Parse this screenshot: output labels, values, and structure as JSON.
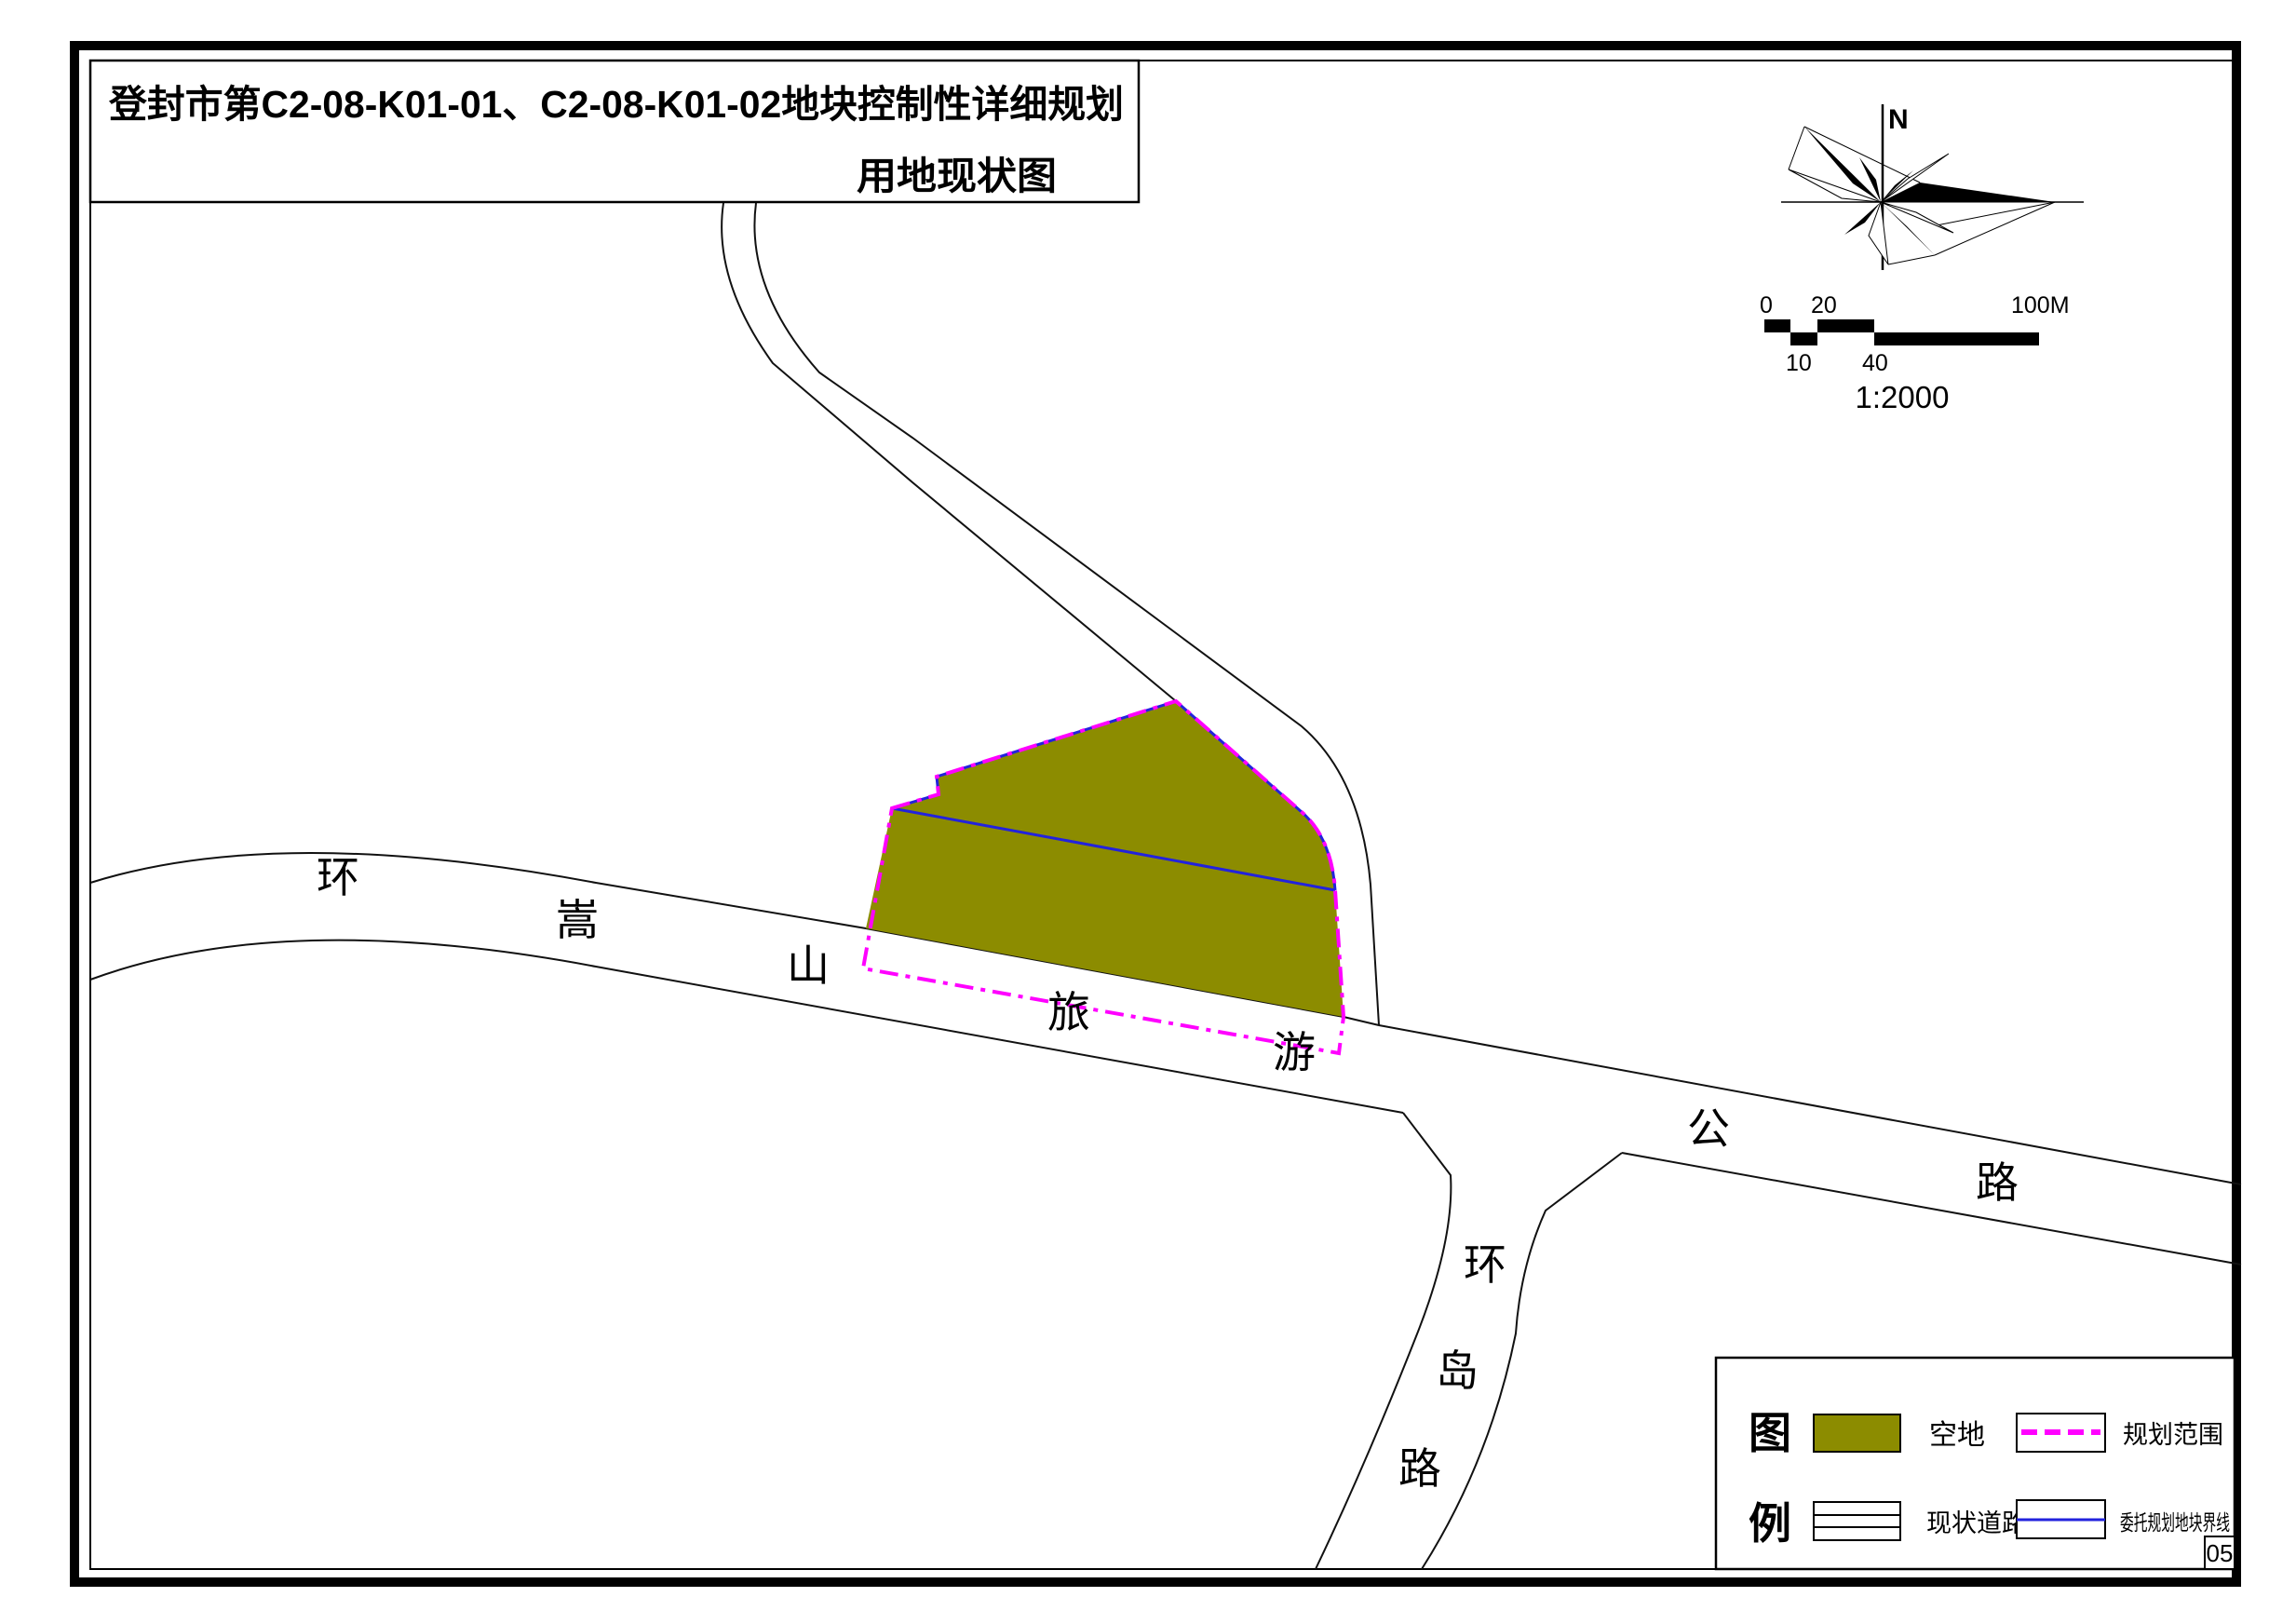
{
  "page": {
    "page_number": "05",
    "background": "#ffffff",
    "border_color": "#000000"
  },
  "title": {
    "line1": "登封市第C2-08-K01-01、C2-08-K01-02地块控制性详细规划",
    "line2": "用地现状图"
  },
  "compass": {
    "north_label": "N"
  },
  "scale_bar": {
    "tick_0": "0",
    "tick_20": "20",
    "tick_100": "100M",
    "tick_10": "10",
    "tick_40": "40",
    "ratio": "1:2000"
  },
  "roads": {
    "ring_songshan_tourism_highway": {
      "name": "环嵩山旅游公路",
      "chars": [
        "环",
        "嵩",
        "山",
        "旅",
        "游",
        "公",
        "路"
      ]
    },
    "ring_island_road": {
      "name": "环岛路",
      "chars": [
        "环",
        "岛",
        "路"
      ]
    }
  },
  "legend": {
    "title_char_1": "图",
    "title_char_2": "例",
    "items": [
      {
        "label": "空地",
        "type": "vacant-land"
      },
      {
        "label": "现状道路",
        "type": "existing-road"
      },
      {
        "label": "规划范围",
        "type": "planning-scope"
      },
      {
        "label": "委托规划地块界线",
        "type": "entrusted-plot-boundary"
      }
    ]
  },
  "colors": {
    "olive": "#8c8c00",
    "magenta": "#ff00ff",
    "blue": "#2222dd",
    "line": "#000000"
  }
}
